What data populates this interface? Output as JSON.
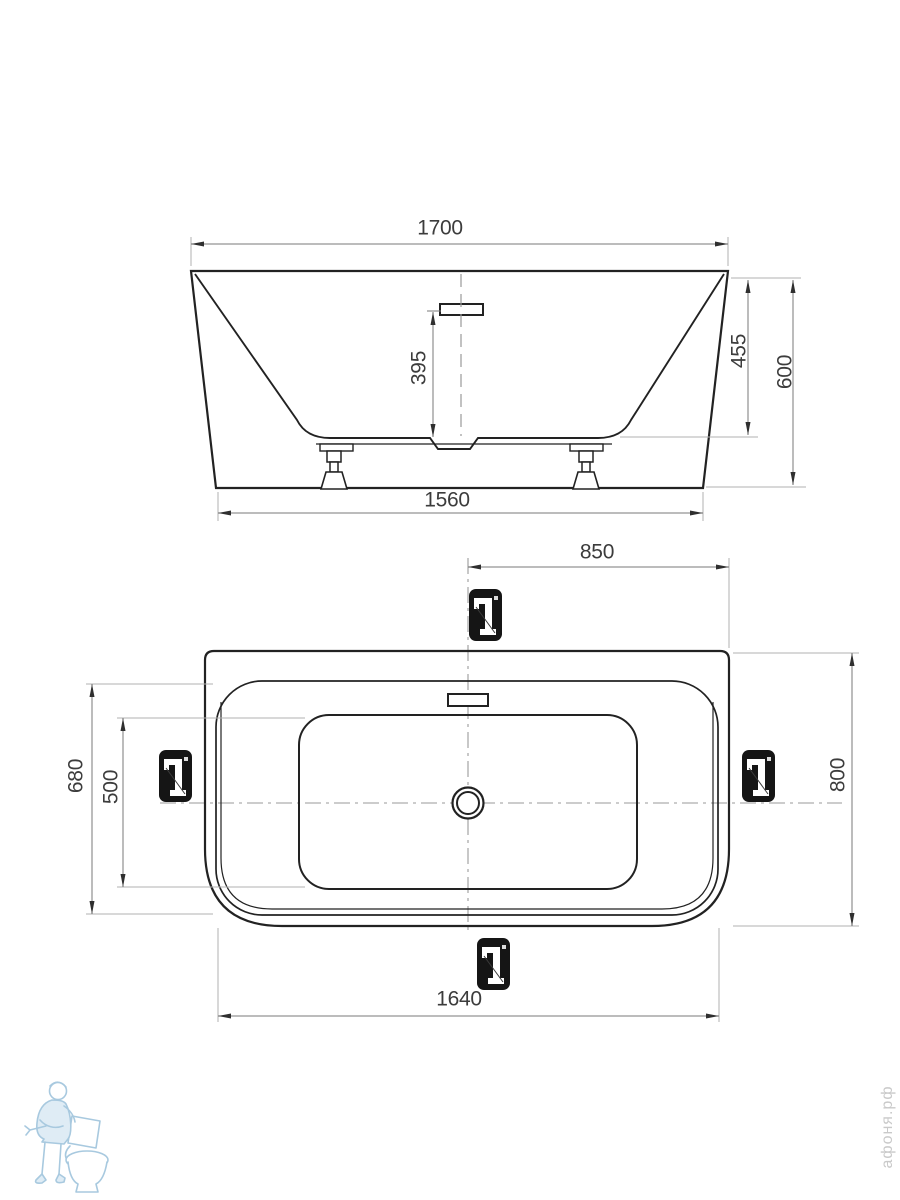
{
  "drawing": {
    "type": "bathtub installation dimensions, two orthographic views",
    "units_shown": false
  },
  "front_view": {
    "dim_overall_width": "1700",
    "dim_overflow_height": "395",
    "dim_inner_depth": "455",
    "dim_overall_height": "600",
    "dim_base_width": "1560"
  },
  "top_view": {
    "dim_center_to_edge": "850",
    "dim_rim_depth": "680",
    "dim_inner_depth": "500",
    "dim_overall_depth": "800",
    "dim_rim_length": "1640"
  },
  "markers": {
    "symbol": "faucet-position-marker",
    "positions": [
      "top",
      "left",
      "right",
      "bottom"
    ]
  },
  "watermarks": {
    "site": "афоня.рф",
    "logo": "plumber-with-toilet",
    "logo_color": "#9fc4dc",
    "site_text_color": "#c9c9c9"
  },
  "colors": {
    "outline": "#222222",
    "dim_line": "#7a7a7a",
    "ext_line": "#b0b0b0",
    "centerline": "#9a9a9a",
    "arrow": "#2f2f2f",
    "badge": "#151515"
  }
}
